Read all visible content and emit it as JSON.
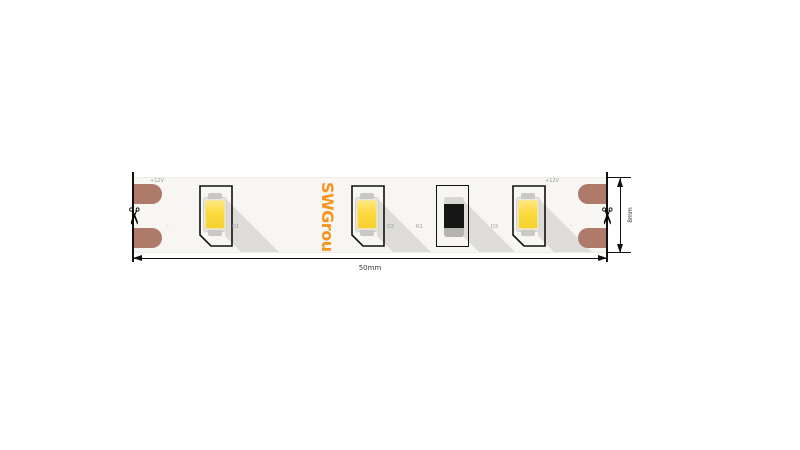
{
  "diagram": {
    "brand": "SWGroup",
    "width_dim": "50mm",
    "height_dim": "8mm",
    "pad_top_label": "+12V",
    "pad_bottom_label": "-",
    "components": [
      {
        "type": "led",
        "label": "D1"
      },
      {
        "type": "led",
        "label": "D2"
      },
      {
        "type": "resistor",
        "label": "R1"
      },
      {
        "type": "led",
        "label": "D3"
      }
    ],
    "scissors_icon": "✂",
    "colors": {
      "brand_orange": "#f7941d",
      "pad_copper": "#ae7a69",
      "led_yellow": "#fcd93f",
      "strip_bg": "#f7f6f3",
      "shadow": "#dddcd8",
      "line": "#111111",
      "tiny_label": "#9a9a9a"
    }
  }
}
